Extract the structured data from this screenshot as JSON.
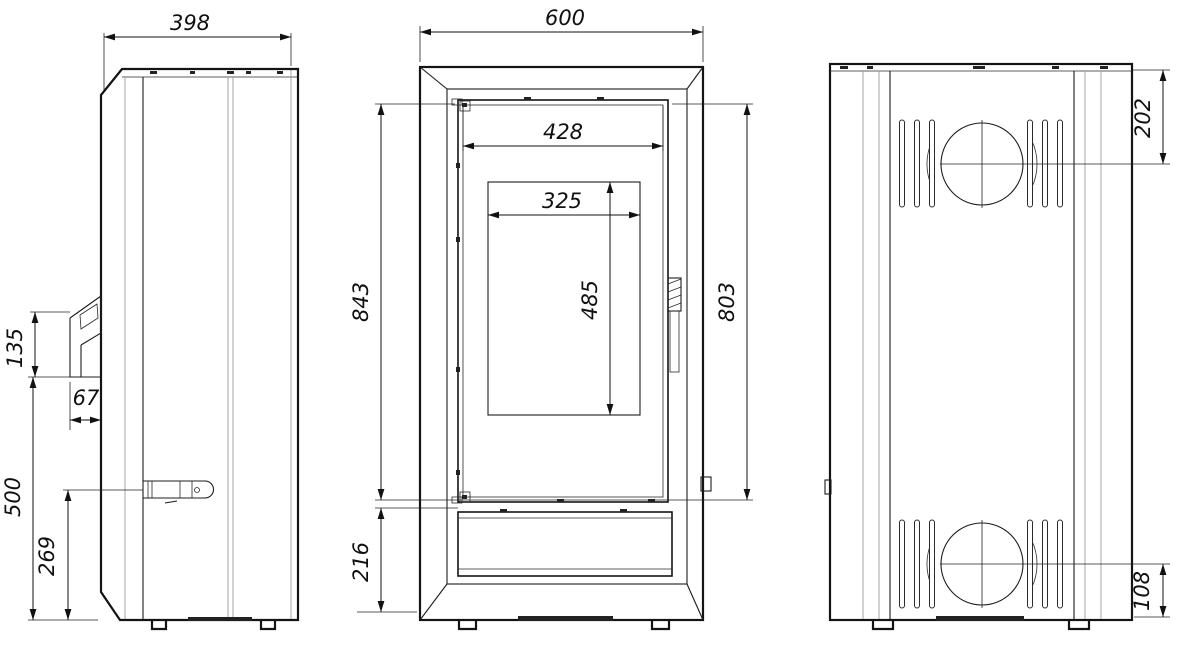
{
  "drawing": {
    "subject": "freestanding-stove-dimension-drawing",
    "colors": {
      "line": "#141414",
      "light_line": "#9a9a9a",
      "background": "#ffffff"
    },
    "dims": {
      "depth": "398",
      "width": "600",
      "door_width": "428",
      "glass_width": "325",
      "body_height": "843",
      "glass_height": "485",
      "door_height": "803",
      "base_height": "216",
      "intake_height": "135",
      "intake_depth": "67",
      "intake_elevation": "500",
      "handle_elevation": "269",
      "flue_center_from_top": "202",
      "inlet_center_from_bottom": "108"
    }
  }
}
